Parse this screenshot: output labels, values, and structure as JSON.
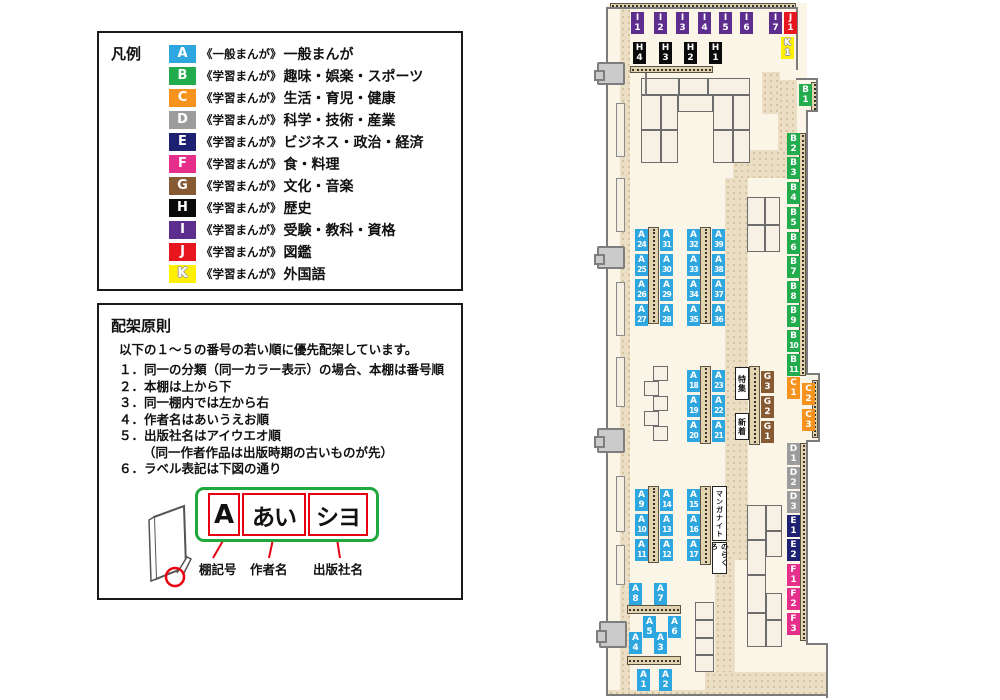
{
  "colors": {
    "A": "#2EA7E0",
    "B": "#22AC4E",
    "C": "#F6921E",
    "D": "#9C9C9D",
    "E": "#1E2171",
    "F": "#E62E8B",
    "G": "#865A33",
    "H": "#0A0A0A",
    "I": "#5D2E8E",
    "J": "#E8171F",
    "K": "#FFF000"
  },
  "legend": {
    "title": "凡例",
    "items": [
      {
        "code": "A",
        "series": "《一般まんが》",
        "category": "一般まんが"
      },
      {
        "code": "B",
        "series": "《学習まんが》",
        "category": "趣味・娯楽・スポーツ"
      },
      {
        "code": "C",
        "series": "《学習まんが》",
        "category": "生活・育児・健康"
      },
      {
        "code": "D",
        "series": "《学習まんが》",
        "category": "科学・技術・産業"
      },
      {
        "code": "E",
        "series": "《学習まんが》",
        "category": "ビジネス・政治・経済"
      },
      {
        "code": "F",
        "series": "《学習まんが》",
        "category": "食・料理"
      },
      {
        "code": "G",
        "series": "《学習まんが》",
        "category": "文化・音楽"
      },
      {
        "code": "H",
        "series": "《学習まんが》",
        "category": "歴史"
      },
      {
        "code": "I",
        "series": "《学習まんが》",
        "category": "受験・教科・資格"
      },
      {
        "code": "J",
        "series": "《学習まんが》",
        "category": "図鑑"
      },
      {
        "code": "K",
        "series": "《学習まんが》",
        "category": "外国語"
      }
    ]
  },
  "principles": {
    "title": "配架原則",
    "intro": "以下の１～５の番号の若い順に優先配架しています。",
    "rules": [
      {
        "num": "１．",
        "text": "同一の分類（同一カラー表示）の場合、本棚は番号順"
      },
      {
        "num": "２．",
        "text": "本棚は上から下"
      },
      {
        "num": "３．",
        "text": "同一棚内では左から右"
      },
      {
        "num": "４．",
        "text": "作者名はあいうえお順"
      },
      {
        "num": "５．",
        "text": "出版社名はアイウエオ順",
        "note": "（同一作者作品は出版時期の古いものが先）"
      },
      {
        "num": "６．",
        "text": "ラベル表記は下図の通り"
      }
    ]
  },
  "label_diagram": {
    "segments": [
      {
        "text": "A",
        "caption": "棚記号"
      },
      {
        "text": "あい",
        "caption": "作者名"
      },
      {
        "text": "シヨ",
        "caption": "出版社名"
      }
    ]
  },
  "map": {
    "floor": [
      {
        "x": 607,
        "y": 3,
        "w": 200,
        "h": 693
      },
      {
        "x": 797,
        "y": 78,
        "w": 21,
        "h": 34
      },
      {
        "x": 806,
        "y": 375,
        "w": 13,
        "h": 65
      },
      {
        "x": 806,
        "y": 643,
        "w": 21,
        "h": 53
      }
    ],
    "corridors": [
      {
        "x": 620,
        "y": 8,
        "w": 10,
        "h": 684
      },
      {
        "x": 762,
        "y": 72,
        "w": 18,
        "h": 42
      },
      {
        "x": 778,
        "y": 80,
        "w": 19,
        "h": 98
      },
      {
        "x": 733,
        "y": 150,
        "w": 64,
        "h": 28
      },
      {
        "x": 725,
        "y": 178,
        "w": 23,
        "h": 382
      },
      {
        "x": 715,
        "y": 555,
        "w": 20,
        "h": 118
      },
      {
        "x": 705,
        "y": 672,
        "w": 122,
        "h": 23
      },
      {
        "x": 608,
        "y": 690,
        "w": 100,
        "h": 6
      }
    ],
    "strips": [
      {
        "x": 610,
        "y": 3,
        "w": 186,
        "h": 6,
        "o": "h"
      },
      {
        "x": 630,
        "y": 66,
        "w": 83,
        "h": 7,
        "o": "h"
      },
      {
        "x": 811,
        "y": 82,
        "w": 7,
        "h": 30,
        "o": "v"
      },
      {
        "x": 799,
        "y": 133,
        "w": 7,
        "h": 243,
        "o": "v"
      },
      {
        "x": 812,
        "y": 380,
        "w": 6,
        "h": 58,
        "o": "v"
      },
      {
        "x": 800,
        "y": 443,
        "w": 7,
        "h": 198,
        "o": "v"
      },
      {
        "x": 648,
        "y": 227,
        "w": 11,
        "h": 97,
        "o": "v"
      },
      {
        "x": 700,
        "y": 227,
        "w": 11,
        "h": 97,
        "o": "v"
      },
      {
        "x": 700,
        "y": 366,
        "w": 11,
        "h": 78,
        "o": "v"
      },
      {
        "x": 749,
        "y": 366,
        "w": 11,
        "h": 79,
        "o": "v"
      },
      {
        "x": 648,
        "y": 486,
        "w": 11,
        "h": 77,
        "o": "v"
      },
      {
        "x": 700,
        "y": 486,
        "w": 11,
        "h": 79,
        "o": "v"
      },
      {
        "x": 627,
        "y": 605,
        "w": 54,
        "h": 9,
        "o": "h"
      },
      {
        "x": 627,
        "y": 656,
        "w": 54,
        "h": 9,
        "o": "h"
      }
    ],
    "tables": [
      {
        "x": 641,
        "y": 78,
        "w": 38,
        "h": 17
      },
      {
        "x": 679,
        "y": 78,
        "w": 29,
        "h": 17
      },
      {
        "x": 708,
        "y": 78,
        "w": 42,
        "h": 17
      },
      {
        "x": 678,
        "y": 95,
        "w": 35,
        "h": 17
      },
      {
        "x": 641,
        "y": 95,
        "w": 20,
        "h": 35
      },
      {
        "x": 661,
        "y": 95,
        "w": 17,
        "h": 35
      },
      {
        "x": 641,
        "y": 130,
        "w": 20,
        "h": 33
      },
      {
        "x": 661,
        "y": 130,
        "w": 17,
        "h": 33
      },
      {
        "x": 713,
        "y": 95,
        "w": 20,
        "h": 35
      },
      {
        "x": 733,
        "y": 95,
        "w": 17,
        "h": 35
      },
      {
        "x": 713,
        "y": 130,
        "w": 20,
        "h": 33
      },
      {
        "x": 733,
        "y": 130,
        "w": 17,
        "h": 33
      },
      {
        "x": 747,
        "y": 197,
        "w": 18,
        "h": 28
      },
      {
        "x": 765,
        "y": 197,
        "w": 15,
        "h": 28
      },
      {
        "x": 747,
        "y": 225,
        "w": 18,
        "h": 27
      },
      {
        "x": 765,
        "y": 225,
        "w": 15,
        "h": 27
      },
      {
        "x": 653,
        "y": 366,
        "w": 15,
        "h": 15
      },
      {
        "x": 644,
        "y": 381,
        "w": 15,
        "h": 15
      },
      {
        "x": 653,
        "y": 396,
        "w": 15,
        "h": 15
      },
      {
        "x": 644,
        "y": 411,
        "w": 15,
        "h": 15
      },
      {
        "x": 653,
        "y": 426,
        "w": 15,
        "h": 15
      },
      {
        "x": 747,
        "y": 505,
        "w": 19,
        "h": 35
      },
      {
        "x": 747,
        "y": 540,
        "w": 19,
        "h": 35
      },
      {
        "x": 747,
        "y": 575,
        "w": 19,
        "h": 38
      },
      {
        "x": 747,
        "y": 613,
        "w": 19,
        "h": 34
      },
      {
        "x": 766,
        "y": 505,
        "w": 16,
        "h": 26
      },
      {
        "x": 766,
        "y": 531,
        "w": 16,
        "h": 26
      },
      {
        "x": 766,
        "y": 593,
        "w": 16,
        "h": 27
      },
      {
        "x": 766,
        "y": 620,
        "w": 16,
        "h": 27
      },
      {
        "x": 695,
        "y": 602,
        "w": 19,
        "h": 18
      },
      {
        "x": 695,
        "y": 620,
        "w": 19,
        "h": 18
      },
      {
        "x": 695,
        "y": 638,
        "w": 19,
        "h": 17
      },
      {
        "x": 695,
        "y": 655,
        "w": 19,
        "h": 17
      }
    ],
    "left_shelves": [
      {
        "x": 616,
        "y": 103,
        "w": 9,
        "h": 54
      },
      {
        "x": 616,
        "y": 178,
        "w": 9,
        "h": 54
      },
      {
        "x": 616,
        "y": 282,
        "w": 9,
        "h": 54
      },
      {
        "x": 616,
        "y": 357,
        "w": 9,
        "h": 50
      },
      {
        "x": 616,
        "y": 476,
        "w": 9,
        "h": 56
      },
      {
        "x": 616,
        "y": 545,
        "w": 9,
        "h": 40
      }
    ],
    "walls": [
      {
        "x": 606,
        "y": 7,
        "w": 2,
        "h": 689
      },
      {
        "x": 606,
        "y": 7,
        "w": 192,
        "h": 2
      },
      {
        "x": 796,
        "y": 7,
        "w": 2,
        "h": 63
      },
      {
        "x": 796,
        "y": 78,
        "w": 22,
        "h": 2
      },
      {
        "x": 816,
        "y": 78,
        "w": 2,
        "h": 34
      },
      {
        "x": 806,
        "y": 110,
        "w": 12,
        "h": 2
      },
      {
        "x": 806,
        "y": 110,
        "w": 2,
        "h": 265
      },
      {
        "x": 806,
        "y": 373,
        "w": 14,
        "h": 2
      },
      {
        "x": 818,
        "y": 373,
        "w": 2,
        "h": 69
      },
      {
        "x": 806,
        "y": 440,
        "w": 14,
        "h": 2
      },
      {
        "x": 806,
        "y": 440,
        "w": 2,
        "h": 205
      },
      {
        "x": 806,
        "y": 643,
        "w": 22,
        "h": 2
      },
      {
        "x": 826,
        "y": 643,
        "w": 2,
        "h": 55
      },
      {
        "x": 606,
        "y": 694,
        "w": 222,
        "h": 2
      },
      {
        "x": 645,
        "y": 73,
        "w": 2,
        "h": 22
      }
    ],
    "doors": [
      {
        "x": 597,
        "y": 62,
        "w": 28,
        "h": 23
      },
      {
        "x": 597,
        "y": 246,
        "w": 28,
        "h": 23
      },
      {
        "x": 597,
        "y": 428,
        "w": 28,
        "h": 25
      },
      {
        "x": 599,
        "y": 621,
        "w": 28,
        "h": 27
      }
    ],
    "labels": [
      {
        "code": "I1",
        "x": 631,
        "y": 12
      },
      {
        "code": "I2",
        "x": 654,
        "y": 12
      },
      {
        "code": "I3",
        "x": 676,
        "y": 12
      },
      {
        "code": "I4",
        "x": 698,
        "y": 12
      },
      {
        "code": "I5",
        "x": 719,
        "y": 12
      },
      {
        "code": "I6",
        "x": 740,
        "y": 12
      },
      {
        "code": "I7",
        "x": 769,
        "y": 12
      },
      {
        "code": "J1",
        "x": 784,
        "y": 12
      },
      {
        "code": "K1",
        "x": 781,
        "y": 37
      },
      {
        "code": "H4",
        "x": 633,
        "y": 42
      },
      {
        "code": "H3",
        "x": 659,
        "y": 42
      },
      {
        "code": "H2",
        "x": 684,
        "y": 42
      },
      {
        "code": "H1",
        "x": 709,
        "y": 42
      },
      {
        "code": "B1",
        "x": 799,
        "y": 84
      },
      {
        "code": "B2",
        "x": 787,
        "y": 133
      },
      {
        "code": "B3",
        "x": 787,
        "y": 157
      },
      {
        "code": "B4",
        "x": 787,
        "y": 182
      },
      {
        "code": "B5",
        "x": 787,
        "y": 207
      },
      {
        "code": "B6",
        "x": 787,
        "y": 232
      },
      {
        "code": "B7",
        "x": 787,
        "y": 256
      },
      {
        "code": "B8",
        "x": 787,
        "y": 281
      },
      {
        "code": "B9",
        "x": 787,
        "y": 305
      },
      {
        "code": "B10",
        "x": 787,
        "y": 330
      },
      {
        "code": "B11",
        "x": 787,
        "y": 354
      },
      {
        "code": "C1",
        "x": 787,
        "y": 377
      },
      {
        "code": "C2",
        "x": 802,
        "y": 383
      },
      {
        "code": "C3",
        "x": 802,
        "y": 409
      },
      {
        "code": "D1",
        "x": 787,
        "y": 443
      },
      {
        "code": "D2",
        "x": 787,
        "y": 467
      },
      {
        "code": "D3",
        "x": 787,
        "y": 491
      },
      {
        "code": "E1",
        "x": 787,
        "y": 515
      },
      {
        "code": "E2",
        "x": 787,
        "y": 539
      },
      {
        "code": "F1",
        "x": 787,
        "y": 564
      },
      {
        "code": "F2",
        "x": 787,
        "y": 588
      },
      {
        "code": "F3",
        "x": 787,
        "y": 613
      },
      {
        "code": "G3",
        "x": 761,
        "y": 371
      },
      {
        "code": "G2",
        "x": 761,
        "y": 396
      },
      {
        "code": "G1",
        "x": 761,
        "y": 421
      },
      {
        "code": "A24",
        "x": 635,
        "y": 229
      },
      {
        "code": "A31",
        "x": 660,
        "y": 229
      },
      {
        "code": "A25",
        "x": 635,
        "y": 254
      },
      {
        "code": "A30",
        "x": 660,
        "y": 254
      },
      {
        "code": "A26",
        "x": 635,
        "y": 279
      },
      {
        "code": "A29",
        "x": 660,
        "y": 279
      },
      {
        "code": "A27",
        "x": 635,
        "y": 304
      },
      {
        "code": "A28",
        "x": 660,
        "y": 304
      },
      {
        "code": "A32",
        "x": 687,
        "y": 229
      },
      {
        "code": "A39",
        "x": 712,
        "y": 229
      },
      {
        "code": "A33",
        "x": 687,
        "y": 254
      },
      {
        "code": "A38",
        "x": 712,
        "y": 254
      },
      {
        "code": "A34",
        "x": 687,
        "y": 279
      },
      {
        "code": "A37",
        "x": 712,
        "y": 279
      },
      {
        "code": "A35",
        "x": 687,
        "y": 304
      },
      {
        "code": "A36",
        "x": 712,
        "y": 304
      },
      {
        "code": "A18",
        "x": 687,
        "y": 370
      },
      {
        "code": "A23",
        "x": 712,
        "y": 370
      },
      {
        "code": "A19",
        "x": 687,
        "y": 395
      },
      {
        "code": "A22",
        "x": 712,
        "y": 395
      },
      {
        "code": "A20",
        "x": 687,
        "y": 420
      },
      {
        "code": "A21",
        "x": 712,
        "y": 420
      },
      {
        "code": "A9",
        "x": 635,
        "y": 489
      },
      {
        "code": "A14",
        "x": 660,
        "y": 489
      },
      {
        "code": "A10",
        "x": 635,
        "y": 514
      },
      {
        "code": "A13",
        "x": 660,
        "y": 514
      },
      {
        "code": "A11",
        "x": 635,
        "y": 539
      },
      {
        "code": "A12",
        "x": 660,
        "y": 539
      },
      {
        "code": "A15",
        "x": 687,
        "y": 489
      },
      {
        "code": "A16",
        "x": 687,
        "y": 514
      },
      {
        "code": "A17",
        "x": 687,
        "y": 539
      },
      {
        "code": "A8",
        "x": 629,
        "y": 583
      },
      {
        "code": "A7",
        "x": 654,
        "y": 583
      },
      {
        "code": "A5",
        "x": 643,
        "y": 616
      },
      {
        "code": "A6",
        "x": 668,
        "y": 616
      },
      {
        "code": "A4",
        "x": 629,
        "y": 632
      },
      {
        "code": "A3",
        "x": 654,
        "y": 632
      },
      {
        "code": "A1",
        "x": 637,
        "y": 669
      },
      {
        "code": "A2",
        "x": 659,
        "y": 669
      }
    ],
    "text_boxes": [
      {
        "id": "special-feature",
        "text": "特集",
        "x": 735,
        "y": 367,
        "w": 14,
        "h": 33,
        "fs": 8
      },
      {
        "id": "new-arrivals",
        "text": "新着",
        "x": 735,
        "y": 413,
        "w": 14,
        "h": 27,
        "fs": 8
      },
      {
        "id": "manga-night",
        "text": "マンガナイト",
        "x": 712,
        "y": 486,
        "w": 15,
        "h": 55,
        "fs": 7
      },
      {
        "id": "norakuro",
        "text": "のらくろ",
        "x": 712,
        "y": 542,
        "w": 15,
        "h": 32,
        "fs": 7
      }
    ]
  }
}
